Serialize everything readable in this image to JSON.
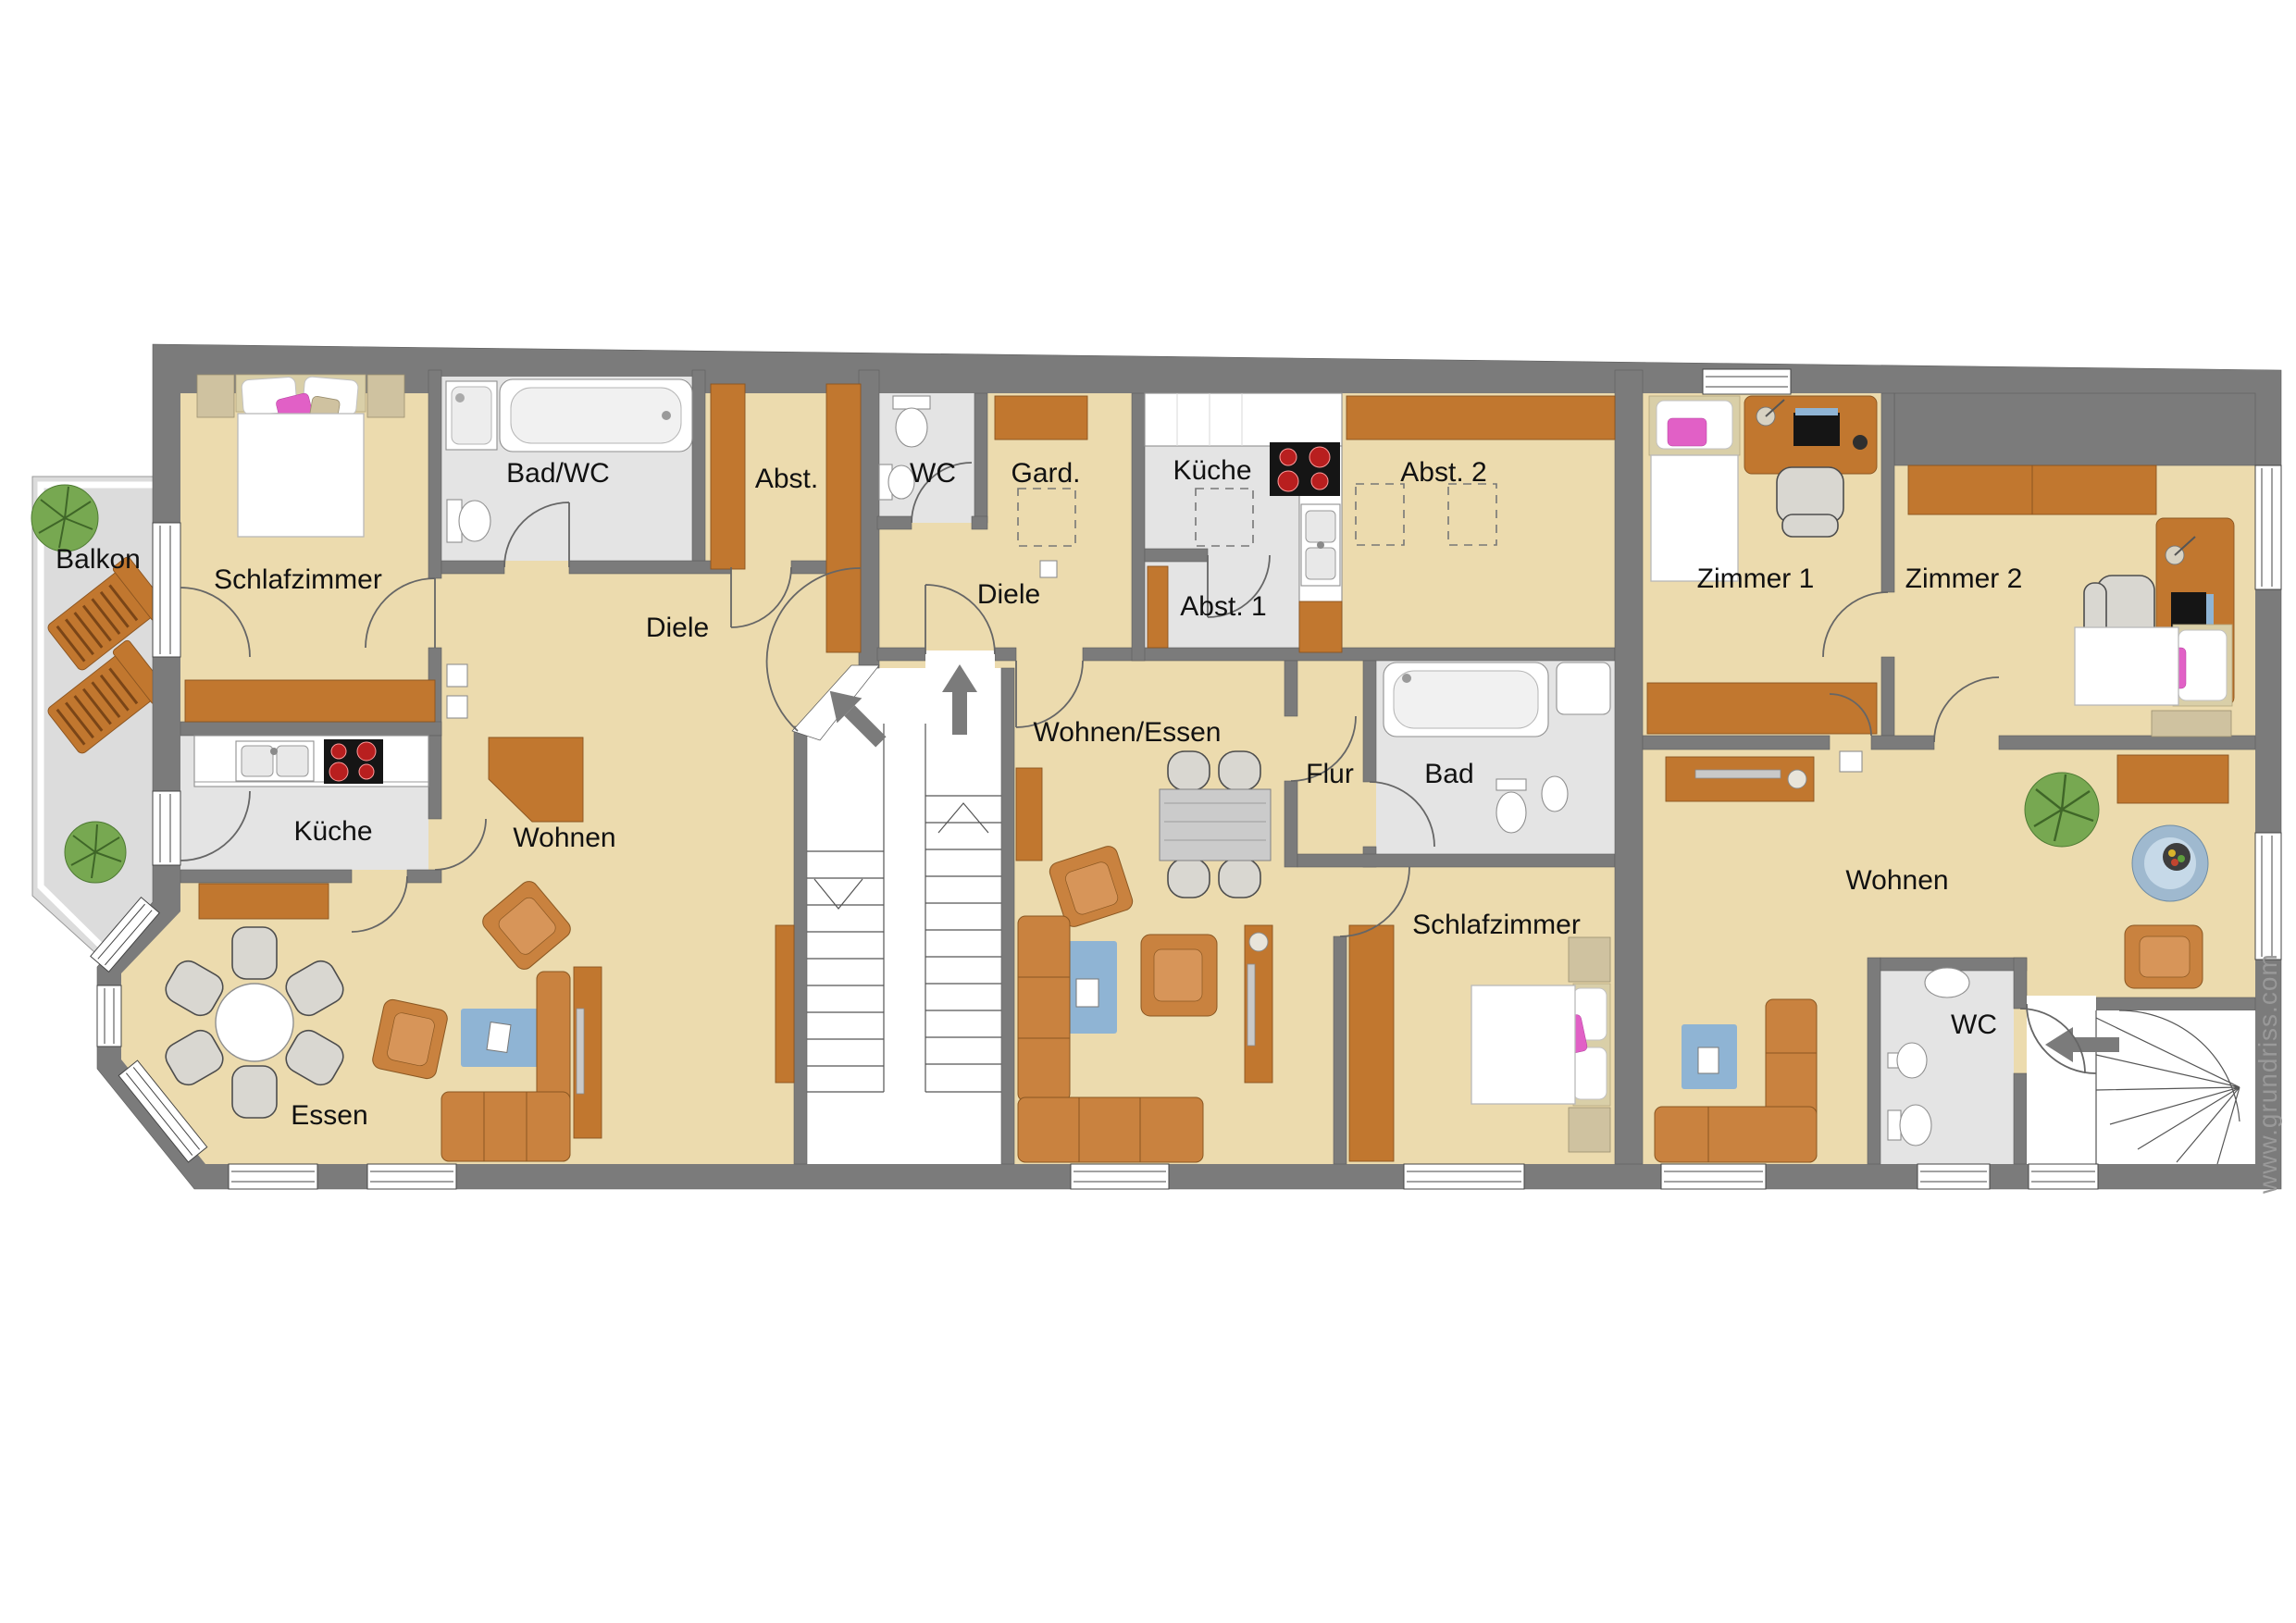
{
  "labels": {
    "balkon": "Balkon",
    "schlafzimmer_left": "Schlafzimmer",
    "bad_wc": "Bad/WC",
    "abstell_left": "Abst.",
    "diele_left": "Diele",
    "kueche_left": "Küche",
    "wohnen_left": "Wohnen",
    "essen_left": "Essen",
    "wc_middle": "WC",
    "garderobe": "Gard.",
    "kueche_middle": "Küche",
    "diele_middle": "Diele",
    "abstell1": "Abst. 1",
    "abstell2": "Abst. 2",
    "wohnen_essen": "Wohnen/Essen",
    "flur": "Flur",
    "bad_middle": "Bad",
    "schlafzimmer_middle": "Schlafzimmer",
    "zimmer1": "Zimmer 1",
    "zimmer2": "Zimmer 2",
    "wohnen_right": "Wohnen",
    "wc_right": "WC"
  },
  "watermark": "www.grundriss.com",
  "colors": {
    "wall": "#7b7b7b",
    "floor": "#ecdbae",
    "tile": "#e4e4e4",
    "balcony": "#dcdcdc",
    "wood": "#c1772f",
    "wood_dark": "#8a5420",
    "sofa": "#c9823f",
    "blue": "#8fb4d4",
    "pink": "#e160c6",
    "green": "#77a851",
    "watermark": "#999999"
  }
}
